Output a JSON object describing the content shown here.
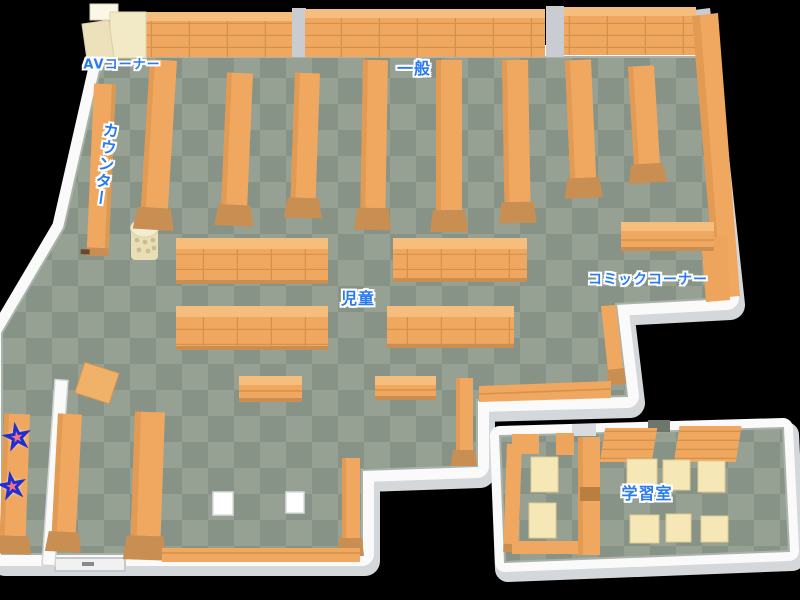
{
  "type": "library-floor-map",
  "labels": {
    "av_corner": "AVコーナー",
    "general": "一般",
    "counter": "カウンター",
    "children": "児童",
    "comic_corner": "コミックコーナー",
    "study_room": "学習室"
  },
  "markers": {
    "star_glyph": "★",
    "star_count": 2,
    "star_fill": "#f4747f",
    "star_outline": "#2030d0"
  },
  "colors": {
    "label_text": "#2b7bf0",
    "label_outline": "#ffffff",
    "shelf_orange": "#f0a75f",
    "shelf_top": "#f6be7d",
    "shelf_dark": "#c98e52",
    "floor_light": "#96a093",
    "floor_dark": "#889388",
    "wall": "#fafafb",
    "cream_furniture": "#f1e7c2",
    "table_cream": "#f6e7b6",
    "background": "#000000"
  }
}
